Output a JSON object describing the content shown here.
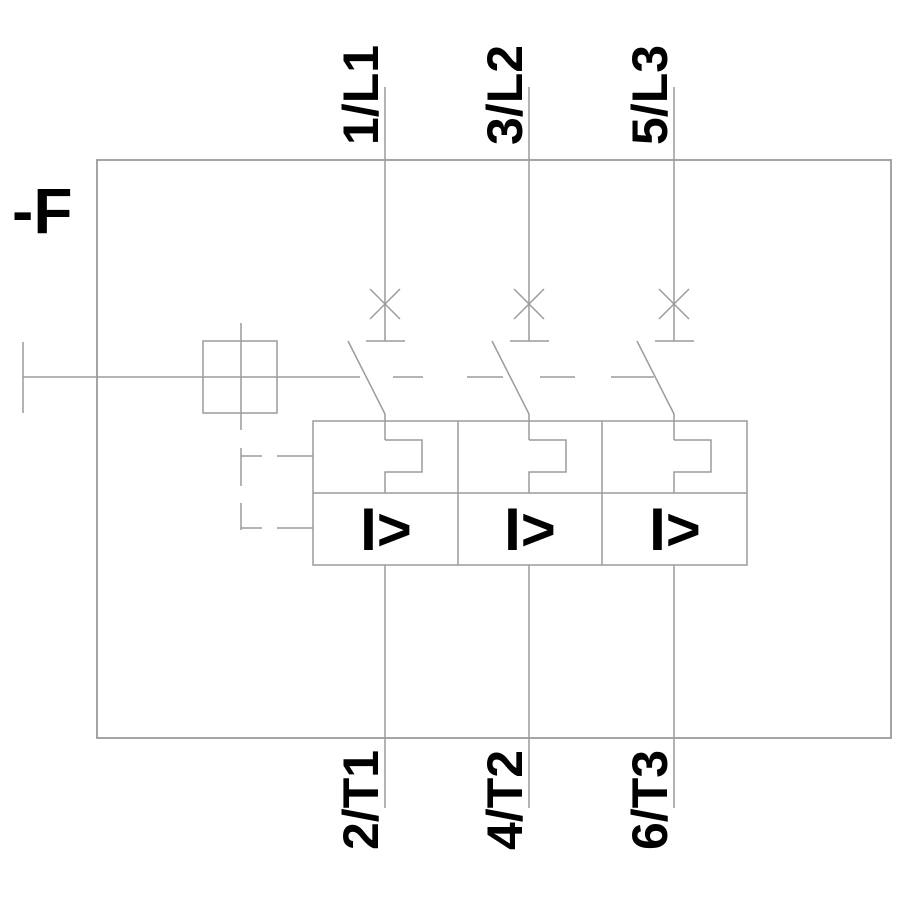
{
  "diagram": {
    "device_label": "-F",
    "poles": [
      {
        "line_terminal": "1/L1",
        "load_terminal": "2/T1",
        "overcurrent_trip_symbol": "I>"
      },
      {
        "line_terminal": "3/L2",
        "load_terminal": "4/T2",
        "overcurrent_trip_symbol": "I>"
      },
      {
        "line_terminal": "5/L3",
        "load_terminal": "6/T3",
        "overcurrent_trip_symbol": "I>"
      }
    ],
    "colors": {
      "line": "#9b9b9b",
      "text": "#000000",
      "background": "#ffffff"
    }
  }
}
